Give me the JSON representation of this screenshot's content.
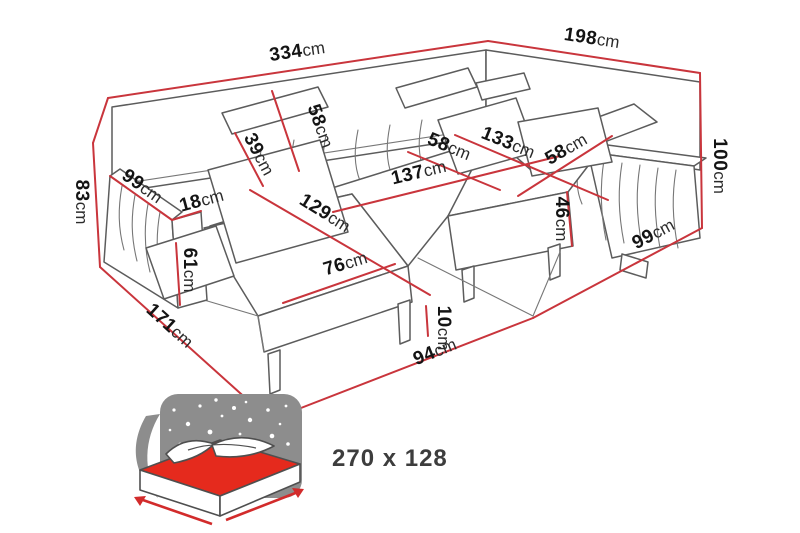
{
  "diagram": {
    "type": "furniture-dimension-diagram",
    "subject": "U-shaped corner sofa with chaise, dimensions in cm",
    "colors": {
      "dimension_line": "#c9353c",
      "artwork_line": "#5c5c5c",
      "mattress_red": "#e52a1d",
      "star_panel_gray": "#8d8d8d",
      "label_text": "#141414",
      "background": "#ffffff"
    },
    "unit": "cm",
    "dimensions": [
      {
        "id": "total-width",
        "value": "334",
        "unit": "cm",
        "line": [
          108,
          98,
          488,
          41
        ],
        "label": [
          298,
          57,
          -8.5
        ]
      },
      {
        "id": "total-depth-right",
        "value": "198",
        "unit": "cm",
        "line": [
          488,
          41,
          700,
          73
        ],
        "label": [
          591,
          44,
          8.5
        ]
      },
      {
        "id": "height-right",
        "value": "100",
        "unit": "cm",
        "line": [
          700,
          73,
          702,
          228
        ],
        "label": [
          714,
          166,
          90
        ]
      },
      {
        "id": "right-floor-depth",
        "value": "99",
        "unit": "cm",
        "line": [
          533,
          318,
          702,
          228
        ],
        "label": [
          656,
          239,
          -28
        ]
      },
      {
        "id": "seat-height",
        "value": "46",
        "unit": "cm",
        "line": [
          567,
          192,
          572,
          246
        ],
        "label": [
          556,
          219,
          90
        ]
      },
      {
        "id": "seat-depth-right",
        "value": "58",
        "unit": "cm",
        "line": [
          518,
          196,
          612,
          136
        ],
        "label": [
          569,
          154,
          -30
        ]
      },
      {
        "id": "right-section-length",
        "value": "133",
        "unit": "cm",
        "line": [
          455,
          135,
          608,
          200
        ],
        "label": [
          506,
          148,
          22
        ]
      },
      {
        "id": "seat-depth-corner",
        "value": "58",
        "unit": "cm",
        "line": [
          408,
          152,
          500,
          190
        ],
        "label": [
          447,
          152,
          22
        ]
      },
      {
        "id": "seat-width-middle",
        "value": "137",
        "unit": "cm",
        "line": [
          333,
          212,
          560,
          156
        ],
        "label": [
          420,
          178,
          -13.5
        ]
      },
      {
        "id": "chaise-seat-length",
        "value": "129",
        "unit": "cm",
        "line": [
          250,
          190,
          430,
          295
        ],
        "label": [
          322,
          218,
          32
        ]
      },
      {
        "id": "chaise-front-width",
        "value": "76",
        "unit": "cm",
        "line": [
          283,
          303,
          395,
          264
        ],
        "label": [
          347,
          269,
          -17
        ]
      },
      {
        "id": "backrest-depth",
        "value": "39",
        "unit": "cm",
        "line": [
          235,
          133,
          263,
          186
        ],
        "label": [
          254,
          157,
          62
        ]
      },
      {
        "id": "backrest-height",
        "value": "58",
        "unit": "cm",
        "line": [
          272,
          91,
          299,
          171
        ],
        "label": [
          315,
          128,
          70
        ]
      },
      {
        "id": "arm-length-left",
        "value": "99",
        "unit": "cm",
        "line": [
          110,
          176,
          172,
          220
        ],
        "label": [
          139,
          191,
          35
        ]
      },
      {
        "id": "arm-width-left",
        "value": "18",
        "unit": "cm",
        "line": [
          172,
          220,
          201,
          211
        ],
        "label": [
          203,
          206,
          -15
        ]
      },
      {
        "id": "arm-height-left",
        "value": "61",
        "unit": "cm",
        "line": [
          176,
          243,
          180,
          305
        ],
        "label": [
          184,
          270,
          90
        ]
      },
      {
        "id": "height-left",
        "value": "83",
        "unit": "cm",
        "line": [
          93,
          143,
          100,
          267
        ],
        "label": [
          76,
          202,
          90
        ]
      },
      {
        "id": "chaise-floor-length",
        "value": "171",
        "unit": "cm",
        "line": [
          100,
          267,
          270,
          420
        ],
        "label": [
          166,
          330,
          42
        ]
      },
      {
        "id": "front-floor-width",
        "value": "94",
        "unit": "cm",
        "line": [
          270,
          420,
          533,
          318
        ],
        "label": [
          437,
          357,
          -22
        ]
      },
      {
        "id": "leg-height",
        "value": "10",
        "unit": "cm",
        "line": [
          426,
          306,
          428,
          336
        ],
        "label": [
          438,
          328,
          90
        ]
      }
    ],
    "outline_extra_lines": [
      [
        108,
        98,
        93,
        143
      ]
    ],
    "sleeping_area": {
      "label": "270 x 128",
      "icon": "sofa-bed-sleeping-function-icon"
    }
  }
}
